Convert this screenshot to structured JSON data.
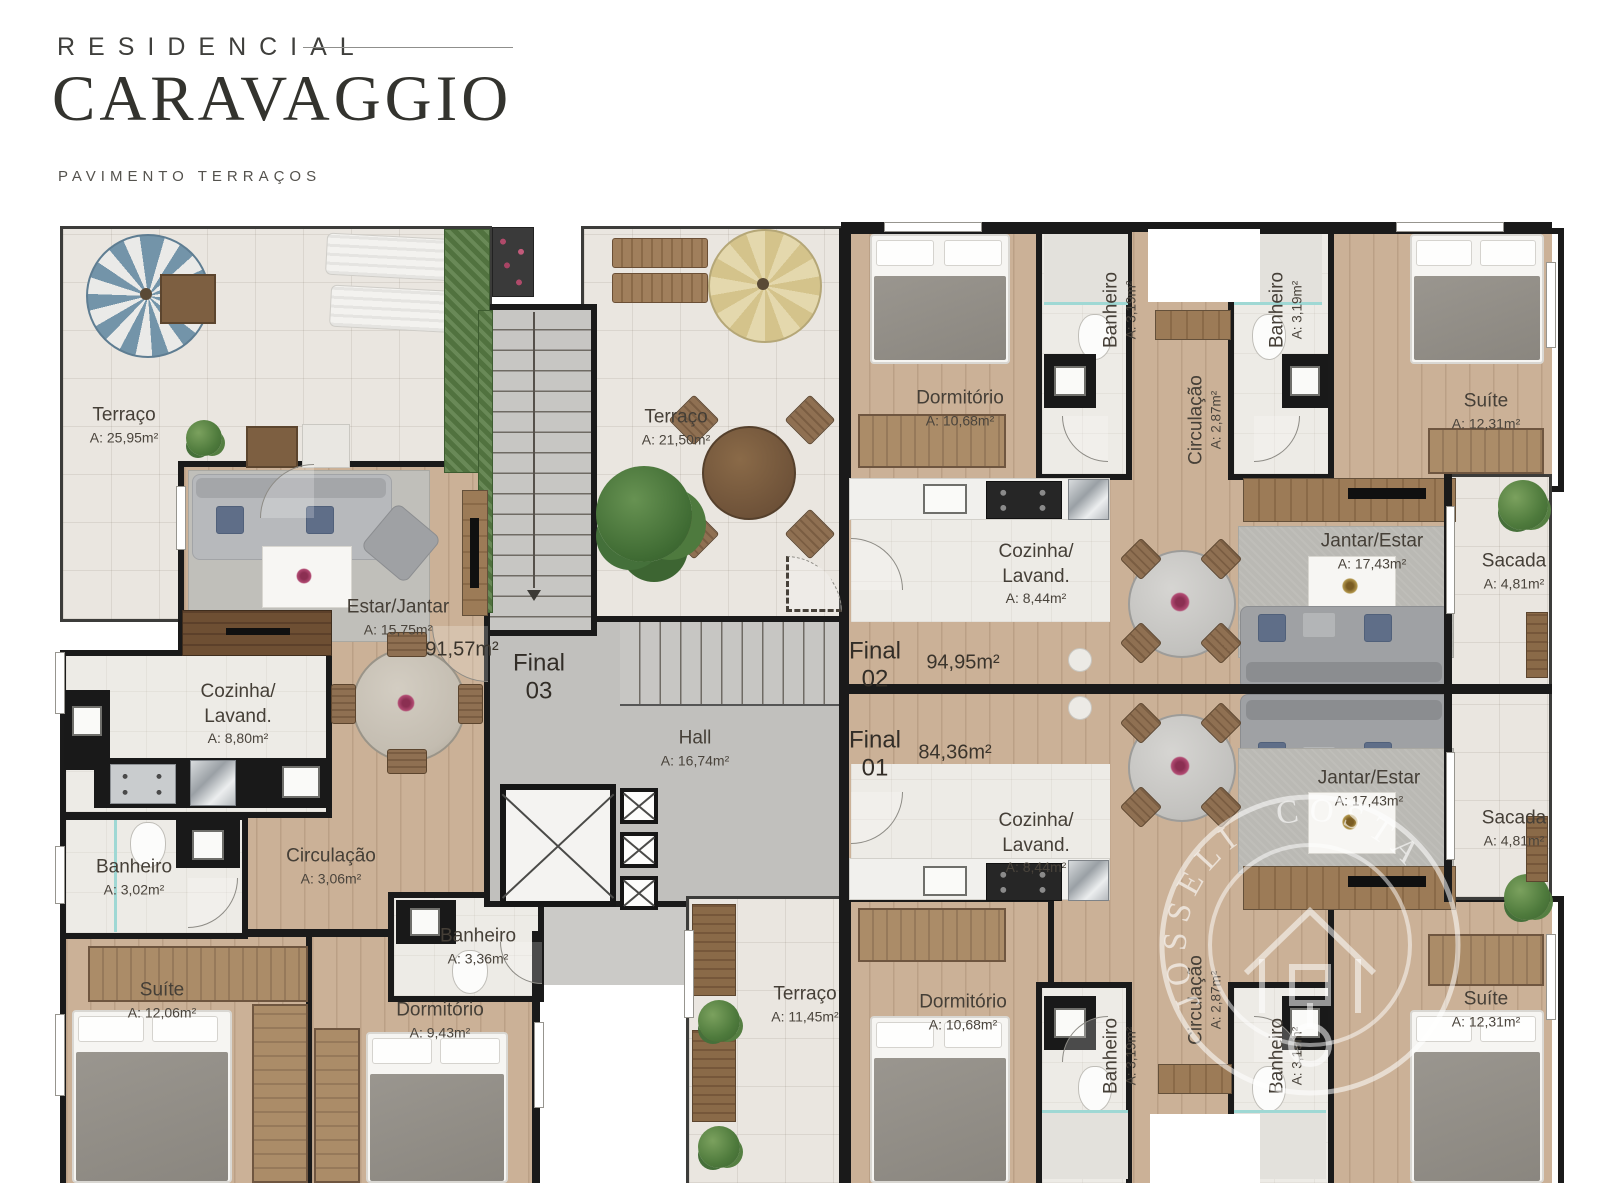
{
  "header": {
    "kicker": "RESIDENCIAL",
    "title": "CARAVAGGIO",
    "subtitle": "PAVIMENTO TERRAÇOS"
  },
  "units": {
    "f03": {
      "label": "Final",
      "number": "03",
      "area": "91,57m²"
    },
    "f02": {
      "label": "Final",
      "number": "02",
      "area": "94,95m²"
    },
    "f01": {
      "label": "Final",
      "number": "01",
      "area": "84,36m²"
    }
  },
  "rooms": {
    "terraco_f03": {
      "name": "Terraço",
      "area": "A: 25,95m²"
    },
    "terraco_mid": {
      "name": "Terraço",
      "area": "A: 21,50m²"
    },
    "terraco_f01": {
      "name": "Terraço",
      "area": "A: 11,45m²"
    },
    "hall": {
      "name": "Hall",
      "area": "A: 16,74m²"
    },
    "estar_f03": {
      "name": "Estar/Jantar",
      "area": "A: 15,75m²"
    },
    "cozinha_f03": {
      "name1": "Cozinha/",
      "name2": "Lavand.",
      "area": "A: 8,80m²"
    },
    "banheiro1_f03": {
      "name": "Banheiro",
      "area": "A: 3,02m²"
    },
    "circulacao_f03": {
      "name": "Circulação",
      "area": "A: 3,06m²"
    },
    "banheiro2_f03": {
      "name": "Banheiro",
      "area": "A: 3,36m²"
    },
    "suite_f03": {
      "name": "Suíte",
      "area": "A: 12,06m²"
    },
    "dormitorio_f03": {
      "name": "Dormitório",
      "area": "A: 9,43m²"
    },
    "dormitorio_f02": {
      "name": "Dormitório",
      "area": "A: 10,68m²"
    },
    "banheiro1_f02": {
      "name": "Banheiro",
      "area": "A: 3,19m²"
    },
    "banheiro2_f02": {
      "name": "Banheiro",
      "area": "A: 3,19m²"
    },
    "circulacao_f02": {
      "name": "Circulação",
      "area": "A: 2,87m²"
    },
    "suite_f02": {
      "name": "Suíte",
      "area": "A: 12,31m²"
    },
    "cozinha_f02": {
      "name1": "Cozinha/",
      "name2": "Lavand.",
      "area": "A: 8,44m²"
    },
    "jantar_f02": {
      "name": "Jantar/Estar",
      "area": "A: 17,43m²"
    },
    "sacada_f02": {
      "name": "Sacada",
      "area": "A: 4,81m²"
    },
    "cozinha_f01": {
      "name1": "Cozinha/",
      "name2": "Lavand.",
      "area": "A: 8,44m²"
    },
    "jantar_f01": {
      "name": "Jantar/Estar",
      "area": "A: 17,43m²"
    },
    "sacada_f01": {
      "name": "Sacada",
      "area": "A: 4,81m²"
    },
    "dormitorio_f01": {
      "name": "Dormitório",
      "area": "A: 10,68m²"
    },
    "banheiro1_f01": {
      "name": "Banheiro",
      "area": "A: 3,19m²"
    },
    "banheiro2_f01": {
      "name": "Banheiro",
      "area": "A: 3,19m²"
    },
    "circulacao_f01": {
      "name": "Circulação",
      "area": "A: 2,87m²"
    },
    "suite_f01": {
      "name": "Suíte",
      "area": "A: 12,31m²"
    }
  },
  "watermark": {
    "text": "JOSSELI COSTA"
  },
  "colors": {
    "wall": "#1a1a1a",
    "wood": "#cbb197",
    "tile": "#eae6e0",
    "concrete": "#c1c0bd",
    "shower_glass": "#9fd8d4"
  }
}
